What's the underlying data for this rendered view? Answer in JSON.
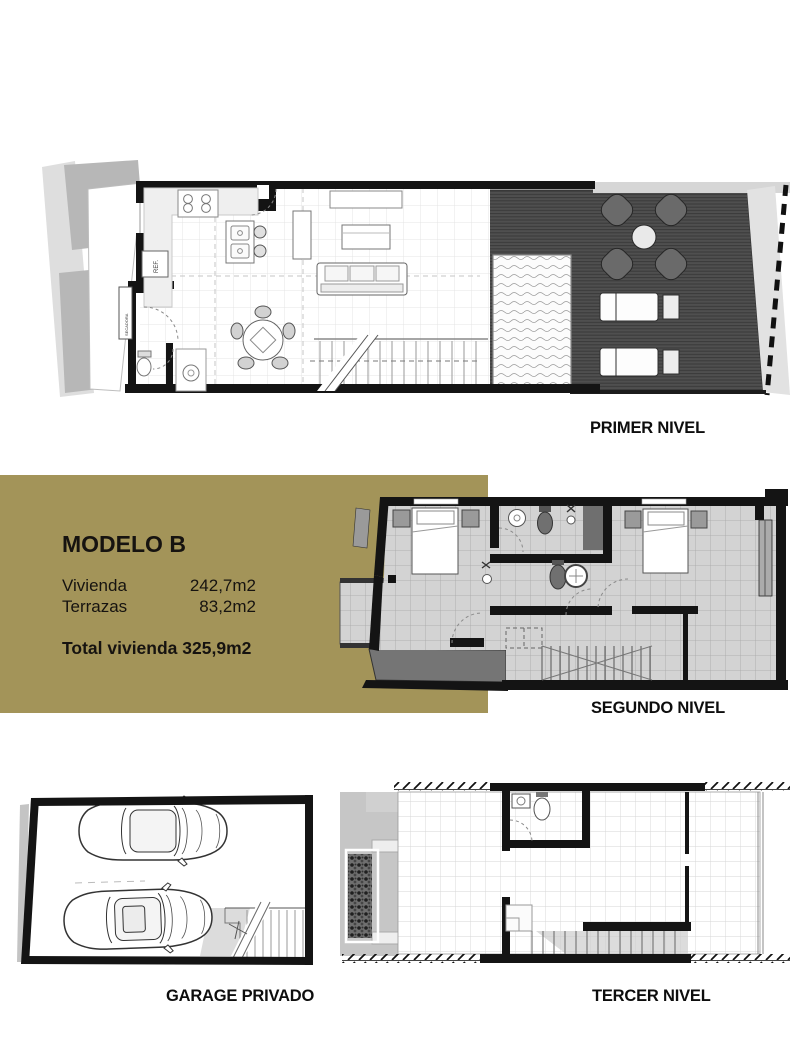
{
  "document": {
    "type": "floor-plan-sheet"
  },
  "colors": {
    "accent_gold": "#a39459",
    "wall_black": "#141414",
    "deck_gray": "#4e4e4e",
    "tile_gray": "#d3d3d3"
  },
  "info_box": {
    "title": "MODELO B",
    "rows": [
      {
        "label": "Vivienda",
        "value": "242,7m2"
      },
      {
        "label": "Terrazas",
        "value": "83,2m2"
      }
    ],
    "total_label": "Total vivienda",
    "total_value": "325,9m2"
  },
  "plan_labels": {
    "primer": "PRIMER NIVEL",
    "segundo": "SEGUNDO NIVEL",
    "garage": "GARAGE PRIVADO",
    "tercer": "TERCER NIVEL"
  },
  "annotations": {
    "fridge": "REF.",
    "laundry": "SECADORA"
  }
}
